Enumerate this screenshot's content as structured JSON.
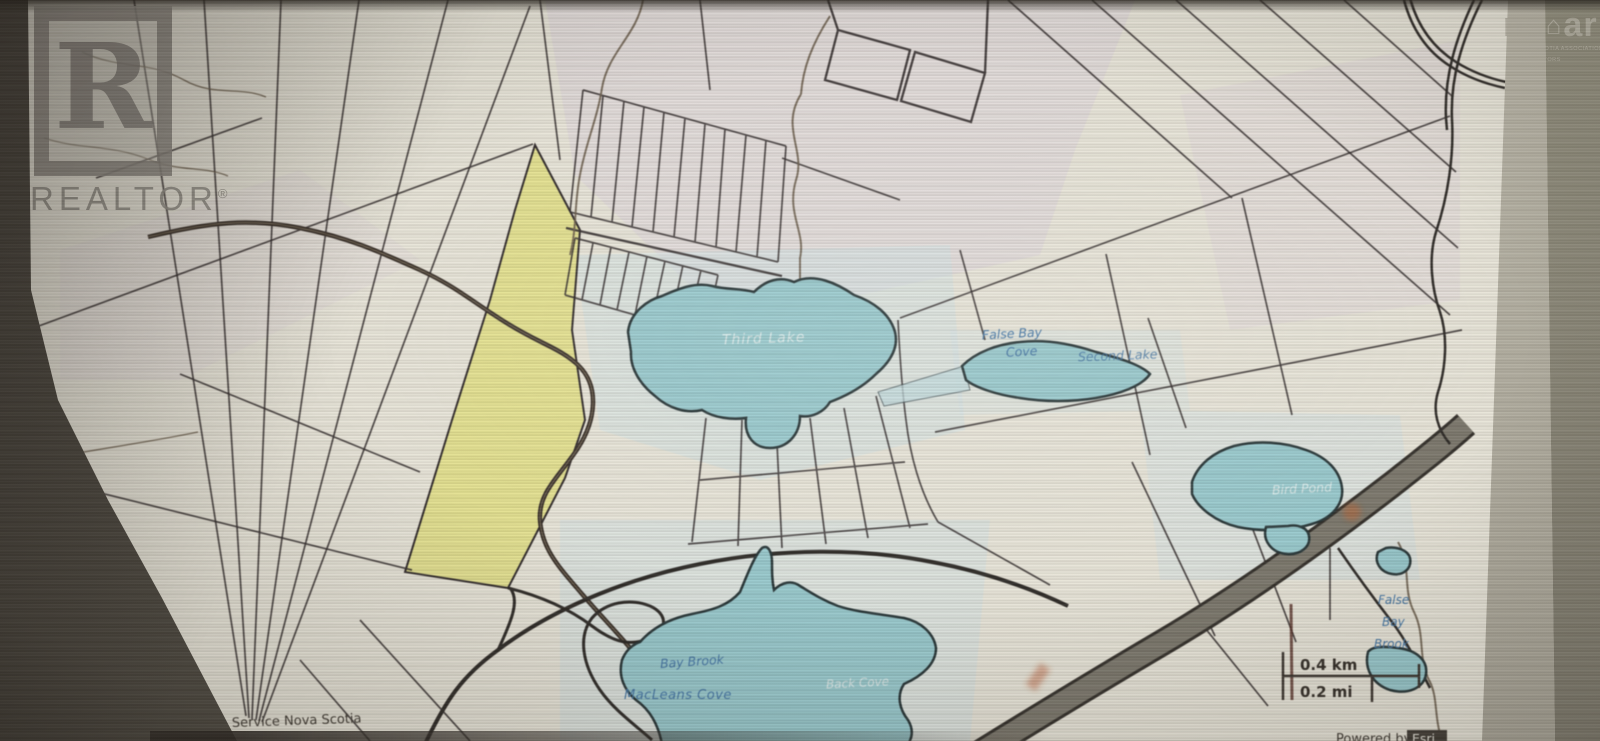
{
  "watermarks": {
    "realtor": {
      "letter": "R",
      "label": "REALTOR",
      "reg": "®"
    },
    "nsar": {
      "ns": "ns",
      "house": "⌂",
      "ar": "ar",
      "caption1": "NOVA SCOTIA ASSOCIATION",
      "caption2": "OF REALTORS"
    }
  },
  "map": {
    "labels": {
      "third_lake": "Third Lake",
      "false_bay": "False Bay",
      "false_bay_2": "Cove",
      "second_lake": "Second Lake",
      "bird_pond": "Bird Pond",
      "bay_brook": "Bay Brook",
      "macleans_cove": "MacLeans Cove",
      "back_cove": "Back Cove",
      "fbb1": "False",
      "fbb2": "Bay",
      "fbb3": "Brook"
    },
    "scale": {
      "km": "0.4 km",
      "mi": "0.2 mi"
    },
    "attribution": {
      "source": "Service Nova Scotia",
      "powered_by": "Powered by",
      "esri": "Esri"
    },
    "colors": {
      "water": "#96ccd1",
      "highlight_parcel": "#e7e489",
      "water_label": "#4179ad",
      "highway": "#7d796c",
      "parcel_line": "#332c2c",
      "background": "#ebe7d9"
    }
  }
}
